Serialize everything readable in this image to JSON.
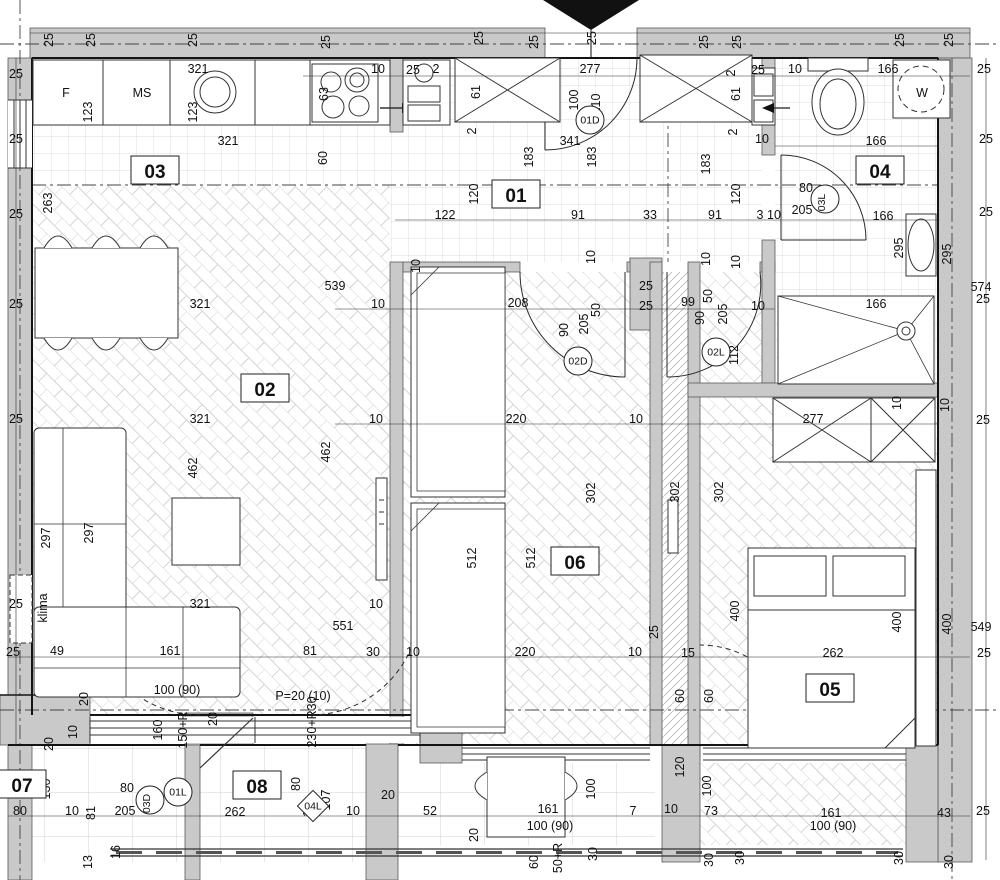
{
  "drawing": {
    "type": "apartment-floor-plan",
    "colors": {
      "wall_fill": "#c9c9c9",
      "wall_edge": "#5a5a5a",
      "line": "#1c1c1c",
      "floor_line": "#d8d8d8",
      "axis": "#444",
      "washer_text": "#8f8f8f"
    },
    "room_tags": [
      {
        "t": "01",
        "x": 516,
        "y": 196
      },
      {
        "t": "02",
        "x": 265,
        "y": 390
      },
      {
        "t": "03",
        "x": 155,
        "y": 172
      },
      {
        "t": "04",
        "x": 880,
        "y": 172
      },
      {
        "t": "05",
        "x": 830,
        "y": 690
      },
      {
        "t": "06",
        "x": 575,
        "y": 563
      },
      {
        "t": "07",
        "x": 22,
        "y": 786
      },
      {
        "t": "08",
        "x": 257,
        "y": 787
      }
    ],
    "door_tags": [
      {
        "t": "01D",
        "x": 590,
        "y": 120
      },
      {
        "t": "02D",
        "x": 578,
        "y": 361
      },
      {
        "t": "02L",
        "x": 716,
        "y": 352
      },
      {
        "t": "03L",
        "x": 825,
        "y": 199,
        "r": -90
      },
      {
        "t": "03D",
        "x": 150,
        "y": 800,
        "r": -90
      },
      {
        "t": "01L",
        "x": 178,
        "y": 792
      },
      {
        "t": "04L",
        "x": 313,
        "y": 806,
        "shape": "diamond"
      }
    ],
    "fixtures": [
      {
        "t": "F",
        "x": 66,
        "y": 97,
        "s": 15
      },
      {
        "t": "MS",
        "x": 142,
        "y": 97,
        "s": 15
      },
      {
        "t": "W",
        "x": 922,
        "y": 97,
        "s": 20,
        "c": "#8f8f8f"
      },
      {
        "t": "klima",
        "x": 47,
        "y": 608,
        "r": -90,
        "s": 14
      },
      {
        "t": "P=20 (10)",
        "x": 303,
        "y": 700,
        "s": 13
      }
    ],
    "dims": [
      {
        "t": "25",
        "x": 53,
        "y": 40,
        "r": -90
      },
      {
        "t": "25",
        "x": 95,
        "y": 40,
        "r": -90
      },
      {
        "t": "25",
        "x": 197,
        "y": 40,
        "r": -90
      },
      {
        "t": "25",
        "x": 330,
        "y": 42,
        "r": -90
      },
      {
        "t": "25",
        "x": 483,
        "y": 38,
        "r": -90
      },
      {
        "t": "25",
        "x": 538,
        "y": 42,
        "r": -90
      },
      {
        "t": "25",
        "x": 596,
        "y": 38,
        "r": -90
      },
      {
        "t": "25",
        "x": 708,
        "y": 42,
        "r": -90
      },
      {
        "t": "25",
        "x": 741,
        "y": 42,
        "r": -90
      },
      {
        "t": "25",
        "x": 904,
        "y": 40,
        "r": -90
      },
      {
        "t": "25",
        "x": 953,
        "y": 40,
        "r": -90
      },
      {
        "t": "25",
        "x": 16,
        "y": 78
      },
      {
        "t": "25",
        "x": 16,
        "y": 143
      },
      {
        "t": "25",
        "x": 16,
        "y": 218
      },
      {
        "t": "25",
        "x": 16,
        "y": 308
      },
      {
        "t": "25",
        "x": 16,
        "y": 423
      },
      {
        "t": "25",
        "x": 16,
        "y": 608
      },
      {
        "t": "25",
        "x": 13,
        "y": 656
      },
      {
        "t": "263",
        "x": 52,
        "y": 203,
        "r": -90
      },
      {
        "t": "49",
        "x": 57,
        "y": 655
      },
      {
        "t": "321",
        "x": 198,
        "y": 73
      },
      {
        "t": "123",
        "x": 92,
        "y": 112,
        "r": -90
      },
      {
        "t": "123",
        "x": 197,
        "y": 112,
        "r": -90
      },
      {
        "t": "321",
        "x": 228,
        "y": 145
      },
      {
        "t": "63",
        "x": 328,
        "y": 94,
        "r": -90
      },
      {
        "t": "10",
        "x": 378,
        "y": 73
      },
      {
        "t": "25",
        "x": 413,
        "y": 74
      },
      {
        "t": "2",
        "x": 436,
        "y": 73
      },
      {
        "t": "60",
        "x": 327,
        "y": 158,
        "r": -90
      },
      {
        "t": "61",
        "x": 480,
        "y": 92,
        "r": -90
      },
      {
        "t": "2",
        "x": 476,
        "y": 131,
        "r": -90
      },
      {
        "t": "277",
        "x": 590,
        "y": 73
      },
      {
        "t": "100",
        "x": 578,
        "y": 100,
        "r": -90
      },
      {
        "t": "210",
        "x": 600,
        "y": 104,
        "r": -90
      },
      {
        "t": "341",
        "x": 570,
        "y": 145
      },
      {
        "t": "183",
        "x": 533,
        "y": 157,
        "r": -90
      },
      {
        "t": "183",
        "x": 596,
        "y": 157,
        "r": -90
      },
      {
        "t": "183",
        "x": 710,
        "y": 164,
        "r": -90
      },
      {
        "t": "2",
        "x": 735,
        "y": 73,
        "r": -90
      },
      {
        "t": "25",
        "x": 758,
        "y": 74
      },
      {
        "t": "61",
        "x": 740,
        "y": 94,
        "r": -90
      },
      {
        "t": "2",
        "x": 737,
        "y": 132,
        "r": -90
      },
      {
        "t": "10",
        "x": 762,
        "y": 143
      },
      {
        "t": "10",
        "x": 795,
        "y": 73
      },
      {
        "t": "166",
        "x": 888,
        "y": 73
      },
      {
        "t": "166",
        "x": 876,
        "y": 145
      },
      {
        "t": "166",
        "x": 883,
        "y": 220
      },
      {
        "t": "166",
        "x": 876,
        "y": 308
      },
      {
        "t": "25",
        "x": 984,
        "y": 73
      },
      {
        "t": "25",
        "x": 986,
        "y": 143
      },
      {
        "t": "25",
        "x": 986,
        "y": 216
      },
      {
        "t": "80",
        "x": 806,
        "y": 192
      },
      {
        "t": "205",
        "x": 802,
        "y": 214
      },
      {
        "t": "295",
        "x": 903,
        "y": 248,
        "r": -90
      },
      {
        "t": "295",
        "x": 951,
        "y": 254,
        "r": -90
      },
      {
        "t": "574",
        "x": 981,
        "y": 291
      },
      {
        "t": "25",
        "x": 983,
        "y": 303
      },
      {
        "t": "120",
        "x": 478,
        "y": 194,
        "r": -90
      },
      {
        "t": "120",
        "x": 740,
        "y": 194,
        "r": -90
      },
      {
        "t": "122",
        "x": 445,
        "y": 219
      },
      {
        "t": "91",
        "x": 578,
        "y": 219
      },
      {
        "t": "33",
        "x": 650,
        "y": 219
      },
      {
        "t": "91",
        "x": 715,
        "y": 219
      },
      {
        "t": "3",
        "x": 760,
        "y": 219
      },
      {
        "t": "10",
        "x": 774,
        "y": 219
      },
      {
        "t": "10",
        "x": 420,
        "y": 266,
        "r": -90
      },
      {
        "t": "10",
        "x": 595,
        "y": 257,
        "r": -90
      },
      {
        "t": "10",
        "x": 710,
        "y": 259,
        "r": -90
      },
      {
        "t": "10",
        "x": 740,
        "y": 262,
        "r": -90
      },
      {
        "t": "539",
        "x": 335,
        "y": 290
      },
      {
        "t": "10",
        "x": 378,
        "y": 308
      },
      {
        "t": "208",
        "x": 518,
        "y": 307
      },
      {
        "t": "90",
        "x": 568,
        "y": 330,
        "r": -90
      },
      {
        "t": "205",
        "x": 588,
        "y": 324,
        "r": -90
      },
      {
        "t": "50",
        "x": 600,
        "y": 310,
        "r": -90
      },
      {
        "t": "25",
        "x": 646,
        "y": 290
      },
      {
        "t": "25",
        "x": 646,
        "y": 310
      },
      {
        "t": "99",
        "x": 688,
        "y": 306
      },
      {
        "t": "90",
        "x": 704,
        "y": 318,
        "r": -90
      },
      {
        "t": "50",
        "x": 712,
        "y": 296,
        "r": -90
      },
      {
        "t": "205",
        "x": 727,
        "y": 314,
        "r": -90
      },
      {
        "t": "10",
        "x": 758,
        "y": 310
      },
      {
        "t": "112",
        "x": 738,
        "y": 355,
        "r": -90
      },
      {
        "t": "277",
        "x": 813,
        "y": 423
      },
      {
        "t": "10",
        "x": 901,
        "y": 403,
        "r": -90
      },
      {
        "t": "10",
        "x": 949,
        "y": 405,
        "r": -90
      },
      {
        "t": "25",
        "x": 983,
        "y": 424
      },
      {
        "t": "321",
        "x": 200,
        "y": 308
      },
      {
        "t": "321",
        "x": 200,
        "y": 423
      },
      {
        "t": "10",
        "x": 376,
        "y": 423
      },
      {
        "t": "220",
        "x": 516,
        "y": 423
      },
      {
        "t": "10",
        "x": 636,
        "y": 423
      },
      {
        "t": "462",
        "x": 197,
        "y": 468,
        "r": -90
      },
      {
        "t": "462",
        "x": 330,
        "y": 452,
        "r": -90
      },
      {
        "t": "302",
        "x": 595,
        "y": 493,
        "r": -90
      },
      {
        "t": "302",
        "x": 679,
        "y": 492,
        "r": -90
      },
      {
        "t": "302",
        "x": 723,
        "y": 492,
        "r": -90
      },
      {
        "t": "512",
        "x": 476,
        "y": 558,
        "r": -90
      },
      {
        "t": "512",
        "x": 535,
        "y": 558,
        "r": -90
      },
      {
        "t": "297",
        "x": 50,
        "y": 538,
        "r": -90
      },
      {
        "t": "297",
        "x": 93,
        "y": 533,
        "r": -90
      },
      {
        "t": "321",
        "x": 200,
        "y": 608
      },
      {
        "t": "10",
        "x": 376,
        "y": 608
      },
      {
        "t": "551",
        "x": 343,
        "y": 630
      },
      {
        "t": "25",
        "x": 658,
        "y": 632,
        "r": -90
      },
      {
        "t": "161",
        "x": 170,
        "y": 655
      },
      {
        "t": "81",
        "x": 310,
        "y": 655
      },
      {
        "t": "30",
        "x": 373,
        "y": 656
      },
      {
        "t": "10",
        "x": 413,
        "y": 656
      },
      {
        "t": "220",
        "x": 525,
        "y": 656
      },
      {
        "t": "10",
        "x": 635,
        "y": 656
      },
      {
        "t": "15",
        "x": 688,
        "y": 657
      },
      {
        "t": "262",
        "x": 833,
        "y": 657
      },
      {
        "t": "25",
        "x": 984,
        "y": 657
      },
      {
        "t": "400",
        "x": 739,
        "y": 611,
        "r": -90
      },
      {
        "t": "400",
        "x": 901,
        "y": 622,
        "r": -90
      },
      {
        "t": "400",
        "x": 951,
        "y": 624,
        "r": -90
      },
      {
        "t": "549",
        "x": 981,
        "y": 631
      },
      {
        "t": "20",
        "x": 88,
        "y": 699,
        "r": -90
      },
      {
        "t": "100 (90)",
        "x": 177,
        "y": 694
      },
      {
        "t": "160",
        "x": 162,
        "y": 730,
        "r": -90
      },
      {
        "t": "150+R",
        "x": 187,
        "y": 730,
        "r": -90
      },
      {
        "t": "20",
        "x": 217,
        "y": 719,
        "r": -90
      },
      {
        "t": "230+R30",
        "x": 316,
        "y": 722,
        "r": -90
      },
      {
        "t": "20",
        "x": 53,
        "y": 744,
        "r": -90
      },
      {
        "t": "10",
        "x": 77,
        "y": 732,
        "r": -90
      },
      {
        "t": "80",
        "x": 20,
        "y": 815
      },
      {
        "t": "130",
        "x": 50,
        "y": 789,
        "r": -90
      },
      {
        "t": "10",
        "x": 72,
        "y": 815
      },
      {
        "t": "81",
        "x": 95,
        "y": 813,
        "r": -90
      },
      {
        "t": "205",
        "x": 125,
        "y": 815
      },
      {
        "t": "80",
        "x": 127,
        "y": 792
      },
      {
        "t": "262",
        "x": 235,
        "y": 816
      },
      {
        "t": "80",
        "x": 300,
        "y": 784,
        "r": -90
      },
      {
        "t": "107",
        "x": 330,
        "y": 800,
        "r": -90
      },
      {
        "t": "16",
        "x": 120,
        "y": 852,
        "r": -90
      },
      {
        "t": "13",
        "x": 92,
        "y": 862,
        "r": -90
      },
      {
        "t": "10",
        "x": 312,
        "y": 810,
        "r": -90
      },
      {
        "t": "10",
        "x": 353,
        "y": 815
      },
      {
        "t": "20",
        "x": 388,
        "y": 799
      },
      {
        "t": "52",
        "x": 430,
        "y": 815
      },
      {
        "t": "20",
        "x": 478,
        "y": 835,
        "r": -90
      },
      {
        "t": "161",
        "x": 548,
        "y": 813
      },
      {
        "t": "100 (90)",
        "x": 550,
        "y": 830
      },
      {
        "t": "100",
        "x": 595,
        "y": 789,
        "r": -90
      },
      {
        "t": "7",
        "x": 633,
        "y": 815
      },
      {
        "t": "60",
        "x": 538,
        "y": 862,
        "r": -90
      },
      {
        "t": "50+R",
        "x": 562,
        "y": 858,
        "r": -90
      },
      {
        "t": "30",
        "x": 597,
        "y": 854,
        "r": -90
      },
      {
        "t": "10",
        "x": 671,
        "y": 813
      },
      {
        "t": "73",
        "x": 711,
        "y": 815
      },
      {
        "t": "120",
        "x": 684,
        "y": 767,
        "r": -90
      },
      {
        "t": "100",
        "x": 711,
        "y": 786,
        "r": -90
      },
      {
        "t": "60",
        "x": 684,
        "y": 696,
        "r": -90
      },
      {
        "t": "60",
        "x": 713,
        "y": 696,
        "r": -90
      },
      {
        "t": "161",
        "x": 831,
        "y": 817
      },
      {
        "t": "100 (90)",
        "x": 833,
        "y": 830
      },
      {
        "t": "43",
        "x": 944,
        "y": 817
      },
      {
        "t": "25",
        "x": 983,
        "y": 815
      },
      {
        "t": "30",
        "x": 713,
        "y": 860,
        "r": -90
      },
      {
        "t": "30",
        "x": 744,
        "y": 858,
        "r": -90
      },
      {
        "t": "30",
        "x": 903,
        "y": 858,
        "r": -90
      },
      {
        "t": "30",
        "x": 953,
        "y": 862,
        "r": -90
      }
    ]
  }
}
